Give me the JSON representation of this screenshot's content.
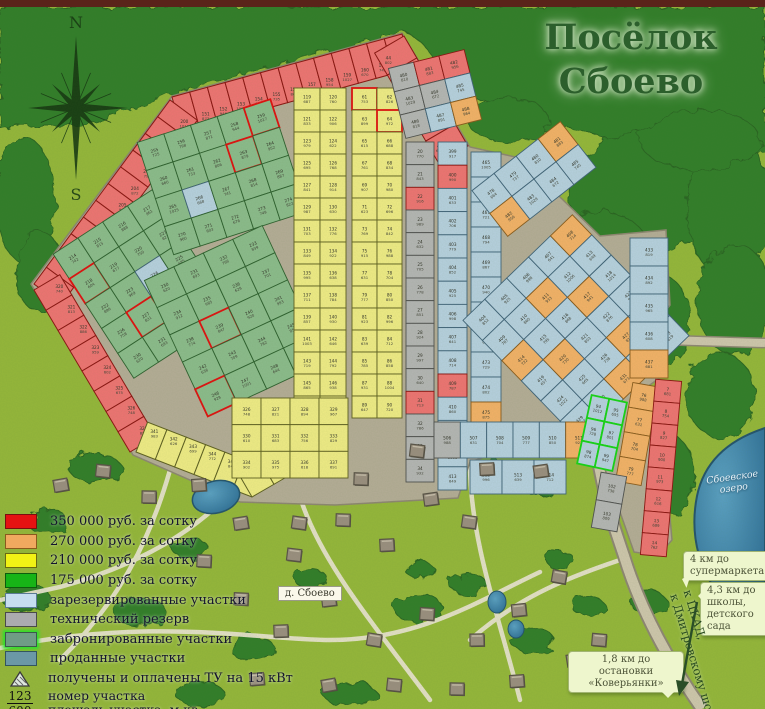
{
  "title": {
    "line1": "Посёлок",
    "line2": "Сбоево"
  },
  "compass": {
    "north": "N",
    "south": "S"
  },
  "legend": {
    "items": [
      {
        "key": "price-350",
        "color": "#e51212",
        "border": "#7a0f0f",
        "label": "350 000 руб. за сотку"
      },
      {
        "key": "price-270",
        "color": "#f0a95f",
        "border": "#8a5a1d",
        "label": "270 000 руб. за сотку"
      },
      {
        "key": "price-210",
        "color": "#f2f215",
        "border": "#6a6a10",
        "label": "210 000 руб. за сотку"
      },
      {
        "key": "price-175",
        "color": "#17b417",
        "border": "#0d5d0d",
        "label": "175 000 руб. за сотку"
      },
      {
        "key": "reserved",
        "color": "#c6ddf0",
        "border": "#5a7a94",
        "label": "зарезервированные участки"
      },
      {
        "key": "tech-reserve",
        "color": "#ababaf",
        "border": "#4a4a4a",
        "label": "технический резерв"
      },
      {
        "key": "booked",
        "color": "#6f9c86",
        "border": "#3a5a4a",
        "glow": true,
        "label": "забронированные участки"
      },
      {
        "key": "sold",
        "color": "#6b98a6",
        "border": "#32555f",
        "label": "проданные участки"
      }
    ],
    "tu_symbol_label": "получены и оплачены ТУ на 15 кВт",
    "fraction": {
      "top": "123",
      "bottom": "600",
      "label_top": "номер участка",
      "label_bottom": "площадь участка, м.кв."
    }
  },
  "map_labels": {
    "village": "д. Сбоево",
    "lake_line1": "Сбоевское",
    "lake_line2": "озеро",
    "road_sign_line1": "к ЦКАД,",
    "road_sign_line2": "к Дмитровскому шоссе",
    "bubbles": [
      {
        "text": "4 км до супермаркета"
      },
      {
        "text": "4,3 км до школы, детского сада"
      },
      {
        "text": "1,8 км до остановки «Коверьянки»"
      }
    ]
  },
  "palette": {
    "red": {
      "fill": "#ef7373",
      "stroke": "#8c1412"
    },
    "orange": {
      "fill": "#f4b168",
      "stroke": "#8a5a1d"
    },
    "yellow": {
      "fill": "#f0eb86",
      "stroke": "#5f5f22"
    },
    "green": {
      "fill": "#8cbb8c",
      "stroke": "#2f6030"
    },
    "blue": {
      "fill": "#b7d0e0",
      "stroke": "#41637a"
    },
    "gray": {
      "fill": "#b5b5b5",
      "stroke": "#505050"
    }
  },
  "note": "per-plot number/area microtext is not legible at source resolution; representative values are generated for display only",
  "zones": [
    {
      "name": "red-top",
      "kind": "strip",
      "from": [
        172,
        97
      ],
      "to": [
        402,
        34
      ],
      "width": 36,
      "cells": 13,
      "side": 1,
      "fill": "red",
      "num_start": 150
    },
    {
      "name": "red-topright",
      "kind": "strip",
      "from": [
        404,
        36
      ],
      "to": [
        468,
        146
      ],
      "width": 34,
      "cells": 5,
      "side": 1,
      "fill": "red",
      "num_start": 44
    },
    {
      "name": "red-left",
      "kind": "strip",
      "from": [
        170,
        100
      ],
      "to": [
        34,
        284
      ],
      "width": 34,
      "cells": 11,
      "side": -1,
      "fill": "red",
      "num_start": 200
    },
    {
      "name": "red-lowerleft",
      "kind": "strip",
      "from": [
        34,
        290
      ],
      "to": [
        130,
        452
      ],
      "width": 30,
      "cells": 8,
      "side": -1,
      "fill": "red",
      "num_start": 320
    },
    {
      "name": "yellow-fan-a",
      "kind": "strip",
      "from": [
        136,
        452
      ],
      "to": [
        252,
        497
      ],
      "width": 32,
      "cells": 6,
      "side": -1,
      "fill": "yellow",
      "num_start": 341
    },
    {
      "name": "yellow-fan-b",
      "kind": "strip",
      "from": [
        252,
        497
      ],
      "to": [
        340,
        446
      ],
      "width": 30,
      "cells": 4,
      "side": -1,
      "fill": "yellow",
      "num_start": 347
    },
    {
      "name": "green-a",
      "kind": "grid",
      "x": 84,
      "y": 210,
      "w": 118,
      "h": 148,
      "rows": 5,
      "cols": 4,
      "rotate": -33,
      "fill": "green",
      "num_start": 214,
      "specials": [
        {
          "r": 1,
          "c": 0,
          "outline": "#e01010"
        },
        {
          "r": 3,
          "c": 1,
          "outline": "#e01010"
        },
        {
          "r": 2,
          "c": 2,
          "fill": "blue"
        }
      ]
    },
    {
      "name": "green-b",
      "kind": "grid",
      "x": 152,
      "y": 118,
      "w": 140,
      "h": 118,
      "rows": 4,
      "cols": 5,
      "rotate": -18,
      "fill": "green",
      "num_start": 255,
      "specials": [
        {
          "r": 0,
          "c": 4,
          "outline": "#e01010"
        },
        {
          "r": 1,
          "c": 3,
          "outline": "#e01010"
        },
        {
          "r": 2,
          "c": 1,
          "fill": "blue"
        }
      ]
    },
    {
      "name": "green-c",
      "kind": "grid",
      "x": 170,
      "y": 246,
      "w": 130,
      "h": 150,
      "rows": 5,
      "cols": 4,
      "rotate": -25,
      "fill": "green",
      "num_start": 230,
      "specials": [
        {
          "r": 2,
          "c": 1,
          "outline": "#e01010"
        },
        {
          "r": 4,
          "c": 0,
          "outline": "#e01010"
        }
      ]
    },
    {
      "name": "yellow-main-left",
      "kind": "grid",
      "x": 294,
      "y": 88,
      "w": 52,
      "h": 330,
      "rows": 15,
      "cols": 2,
      "fill": "yellow",
      "num_start": 119
    },
    {
      "name": "yellow-main-right",
      "kind": "grid",
      "x": 352,
      "y": 88,
      "w": 50,
      "h": 330,
      "rows": 15,
      "cols": 2,
      "fill": "yellow",
      "num_start": 61,
      "specials": [
        {
          "r": 0,
          "c": 0,
          "outline": "#e01010"
        },
        {
          "r": 1,
          "c": 1,
          "outline": "#e01010"
        }
      ]
    },
    {
      "name": "yellow-lower",
      "kind": "grid",
      "x": 232,
      "y": 398,
      "w": 116,
      "h": 80,
      "rows": 3,
      "cols": 4,
      "fill": "yellow",
      "num_start": 326
    },
    {
      "name": "gray-column",
      "kind": "grid",
      "x": 406,
      "y": 142,
      "w": 28,
      "h": 340,
      "rows": 15,
      "cols": 1,
      "fill": "gray",
      "num_start": 20,
      "specials": [
        {
          "r": 2,
          "c": 0,
          "fill": "red"
        },
        {
          "r": 11,
          "c": 0,
          "fill": "red"
        }
      ]
    },
    {
      "name": "blue-column-a",
      "kind": "grid",
      "x": 438,
      "y": 142,
      "w": 29,
      "h": 348,
      "rows": 15,
      "cols": 1,
      "fill": "blue",
      "num_start": 399,
      "specials": [
        {
          "r": 1,
          "c": 0,
          "fill": "red"
        },
        {
          "r": 10,
          "c": 0,
          "fill": "red"
        }
      ]
    },
    {
      "name": "blue-column-b",
      "kind": "grid",
      "x": 471,
      "y": 152,
      "w": 30,
      "h": 300,
      "rows": 12,
      "cols": 1,
      "fill": "blue",
      "num_start": 465,
      "specials": [
        {
          "r": 10,
          "c": 0,
          "fill": "orange"
        }
      ]
    },
    {
      "name": "mixed-top-wedge",
      "kind": "grid",
      "x": 396,
      "y": 58,
      "w": 78,
      "h": 72,
      "rows": 3,
      "cols": 3,
      "rotate": -14,
      "fill": "gray",
      "num_start": 480,
      "specials": [
        {
          "r": 0,
          "c": 1,
          "fill": "red"
        },
        {
          "r": 0,
          "c": 2,
          "fill": "red"
        },
        {
          "r": 1,
          "c": 2,
          "fill": "blue"
        },
        {
          "r": 2,
          "c": 1,
          "fill": "blue"
        },
        {
          "r": 2,
          "c": 2,
          "fill": "orange"
        }
      ]
    },
    {
      "name": "blue-band-ne",
      "kind": "grid",
      "x": 478,
      "y": 150,
      "w": 112,
      "h": 58,
      "rows": 2,
      "cols": 4,
      "rotate": -38,
      "fill": "blue",
      "num_start": 478,
      "specials": [
        {
          "r": 0,
          "c": 3,
          "fill": "orange"
        },
        {
          "r": 1,
          "c": 0,
          "fill": "orange"
        }
      ]
    },
    {
      "name": "blue-diagonal",
      "kind": "grid",
      "x": 500,
      "y": 244,
      "w": 152,
      "h": 168,
      "rows": 6,
      "cols": 5,
      "rotate": -44,
      "fill": "blue",
      "num_start": 404,
      "specials": [
        {
          "r": 1,
          "c": 2,
          "fill": "orange"
        },
        {
          "r": 2,
          "c": 3,
          "fill": "orange"
        },
        {
          "r": 3,
          "c": 1,
          "fill": "orange"
        },
        {
          "r": 4,
          "c": 3,
          "fill": "orange"
        },
        {
          "r": 2,
          "c": 0,
          "fill": "orange"
        },
        {
          "r": 5,
          "c": 2,
          "fill": "orange"
        },
        {
          "r": 0,
          "c": 4,
          "fill": "orange"
        }
      ]
    },
    {
      "name": "blue-right-edge",
      "kind": "grid",
      "x": 630,
      "y": 238,
      "w": 38,
      "h": 140,
      "rows": 5,
      "cols": 1,
      "fill": "blue",
      "num_start": 433,
      "specials": [
        {
          "r": 4,
          "c": 0,
          "fill": "orange"
        }
      ]
    },
    {
      "name": "blue-bottom-row",
      "kind": "grid",
      "x": 434,
      "y": 422,
      "w": 158,
      "h": 36,
      "rows": 1,
      "cols": 6,
      "fill": "blue",
      "num_start": 506,
      "specials": [
        {
          "r": 0,
          "c": 0,
          "fill": "gray"
        },
        {
          "r": 0,
          "c": 5,
          "fill": "orange"
        }
      ]
    },
    {
      "name": "blue-bottom-row2",
      "kind": "grid",
      "x": 470,
      "y": 460,
      "w": 96,
      "h": 34,
      "rows": 1,
      "cols": 3,
      "fill": "blue",
      "num_start": 512
    },
    {
      "name": "exit-sold",
      "kind": "grid",
      "x": 584,
      "y": 398,
      "w": 36,
      "h": 70,
      "rows": 3,
      "cols": 2,
      "rotate": 12,
      "fill": "blue",
      "outline_all": "#17d417",
      "num_start": 94
    },
    {
      "name": "exit-orange",
      "kind": "grid",
      "x": 624,
      "y": 384,
      "w": 26,
      "h": 100,
      "rows": 4,
      "cols": 1,
      "rotate": 10,
      "fill": "orange",
      "num_start": 76
    },
    {
      "name": "exit-red",
      "kind": "grid",
      "x": 648,
      "y": 380,
      "w": 26,
      "h": 176,
      "rows": 8,
      "cols": 1,
      "rotate": 5,
      "fill": "red",
      "num_start": 7
    },
    {
      "name": "exit-gray",
      "kind": "grid",
      "x": 596,
      "y": 474,
      "w": 26,
      "h": 56,
      "rows": 2,
      "cols": 1,
      "rotate": 10,
      "fill": "gray",
      "num_start": 102
    }
  ]
}
